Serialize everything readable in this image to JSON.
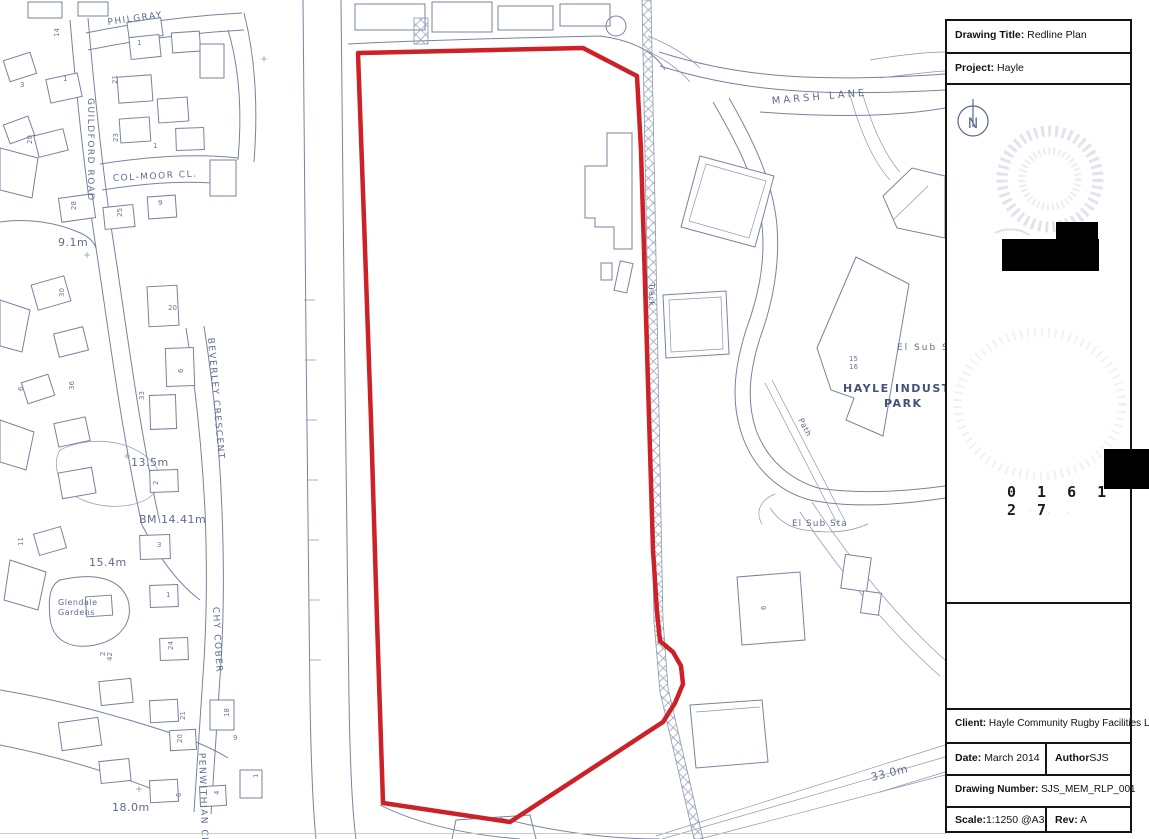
{
  "colors": {
    "boundary_red": "#cc2127",
    "map_line": "#7683a1",
    "map_text": "#5f6c8e",
    "railway_hatch": "#98a1b6",
    "panel_border": "#141414"
  },
  "map": {
    "streets": {
      "philgray": "PHILGRAY",
      "guildford_road": "GUILDFORD ROAD",
      "col_moor_cl": "COL-MOOR CL.",
      "beverley_crescent": "BEVERLEY CRESCENT",
      "chy_cober": "CHY COBER",
      "penwithian_cl": "PENWITHIAN CL",
      "glendale_1": "Glendale",
      "glendale_2": "Gardens",
      "marsh_lane": "MARSH LANE"
    },
    "places": {
      "track": "Track",
      "path": "Path",
      "el_sub_s": "El Sub S",
      "el_sub_sta": "El Sub Sta",
      "hayle_industrial_1": "HAYLE INDUSTRIAL",
      "hayle_industrial_2": "PARK",
      "unit_15": "15",
      "unit_16": "16",
      "unit_6": "6"
    },
    "heights": {
      "h_9_1": "9.1m",
      "h_13_5": "13.5m",
      "h_bm": "BM 14.41m",
      "h_15_4": "15.4m",
      "h_18_0": "18.0m",
      "h_33_0": "33.0m"
    },
    "house_numbers": [
      "14",
      "3",
      "1",
      "21",
      "1",
      "23",
      "1",
      "20",
      "28",
      "25",
      "9",
      "30",
      "20",
      "6",
      "33",
      "36",
      "6",
      "2",
      "3",
      "1",
      "11",
      "24",
      "42",
      "21",
      "20",
      "18",
      "9",
      "6",
      "4",
      "1",
      "2"
    ]
  },
  "title_block": {
    "drawing_title_label": "Drawing Title:",
    "drawing_title": "Redline Plan",
    "project_label": "Project:",
    "project": "Hayle",
    "north_letter": "N",
    "stamp_number": "0 1 6 1 2 7",
    "client_label": "Client:",
    "client": "Hayle Community Rugby Facilities Ltd",
    "date_label": "Date:",
    "date": "March  2014",
    "author_label": "Author",
    "author": "SJS",
    "drawing_number_label": "Drawing Number:",
    "drawing_number": "SJS_MEM_RLP_001",
    "scale_label": "Scale:",
    "scale": "1:1250  @A3",
    "rev_label": "Rev:",
    "rev": "A"
  }
}
